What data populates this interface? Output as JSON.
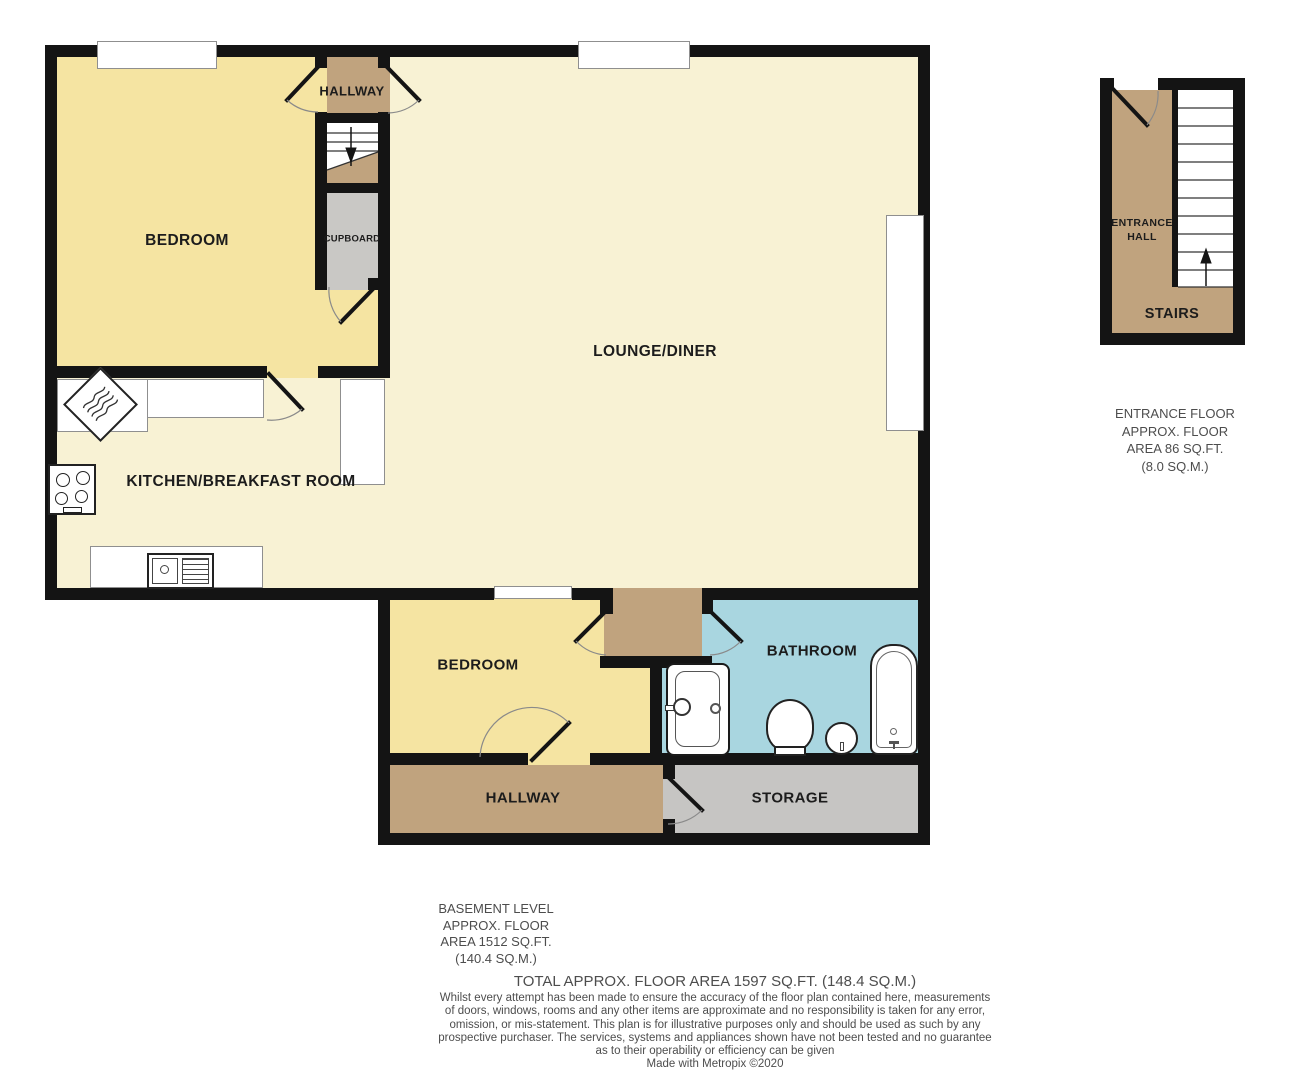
{
  "colors": {
    "wall": "#141414",
    "bedroom": "#f5e4a2",
    "cream": "#f8f2d4",
    "tan": "#c0a37e",
    "cupboard": "#c9c8c5",
    "storage": "#c6c5c3",
    "bath": "#a9d6e0",
    "white": "#ffffff",
    "label": "#1c1c1c",
    "note": "#4d4d4d",
    "frame": "#8f8f8f"
  },
  "basement": {
    "rooms": {
      "hallway_upper": "HALLWAY",
      "cupboard": "CUPBOARD",
      "bedroom1": "BEDROOM",
      "lounge": "LOUNGE/DINER",
      "kitchen": "KITCHEN/BREAKFAST ROOM",
      "bedroom2": "BEDROOM",
      "bathroom": "BATHROOM",
      "hallway_lower": "HALLWAY",
      "storage": "STORAGE"
    },
    "area_note": {
      "lines": [
        "BASEMENT LEVEL",
        "APPROX. FLOOR",
        "AREA 1512 SQ.FT.",
        "(140.4 SQ.M.)"
      ]
    }
  },
  "entrance": {
    "rooms": {
      "entrance_hall_line1": "ENTRANCE",
      "entrance_hall_line2": "HALL",
      "stairs": "STAIRS"
    },
    "area_note": {
      "lines": [
        "ENTRANCE FLOOR",
        "APPROX. FLOOR",
        "AREA 86 SQ.FT.",
        "(8.0 SQ.M.)"
      ]
    }
  },
  "footer": {
    "total": "TOTAL APPROX. FLOOR AREA 1597 SQ.FT. (148.4 SQ.M.)",
    "disclaimer_lines": [
      "Whilst every attempt has been made to ensure the accuracy of the floor plan contained here, measurements",
      "of doors, windows, rooms and any other items are approximate and no responsibility is taken for any error,",
      "omission, or mis-statement. This plan is for illustrative purposes only and should be used as such by any",
      "prospective purchaser. The services, systems and appliances shown have not been tested and no guarantee",
      "as to their operability or efficiency can be given",
      "Made with Metropix ©2020"
    ]
  }
}
